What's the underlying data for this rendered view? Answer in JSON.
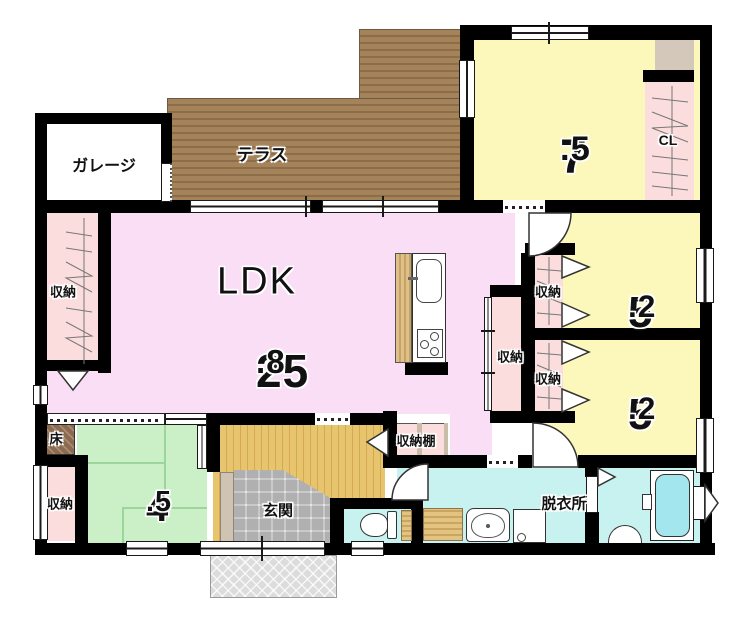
{
  "plan": {
    "labels": {
      "garage": "ガレージ",
      "terrace": "テラス",
      "ldk": "LDK",
      "cl": "CL",
      "closet_left": "収納",
      "closet_mid": "収納",
      "closet_a": "収納",
      "closet_b": "収納",
      "closet_bottom": "収納",
      "shelf": "収納棚",
      "tokonoma": "床",
      "genkan": "玄関",
      "dressing": "脱衣所"
    },
    "areas": {
      "ldk": {
        "int": "25",
        "frac": ".8"
      },
      "room75": {
        "int": "7",
        "frac": ".5"
      },
      "room52a": {
        "int": "5",
        "frac": ".2"
      },
      "room52b": {
        "int": "5",
        "frac": ".2"
      },
      "room45": {
        "int": "4",
        "frac": ".5"
      }
    },
    "colors": {
      "wall": "#000000",
      "ldk_pink": "#f9def5",
      "room_yellow": "#fcf8bc",
      "closet_pink": "#fbdddd",
      "tatami_green": "#cbf0c8",
      "wet_cyan": "#c8f2f0",
      "tub_cyan": "#a3e6ee",
      "terrace_brown": "#9d7c53",
      "hall_wood": "#e7c46e",
      "tile_gray": "#d4d4d4",
      "tokonoma_brown": "#8a6a50",
      "beige": "#d4c8ba"
    }
  }
}
